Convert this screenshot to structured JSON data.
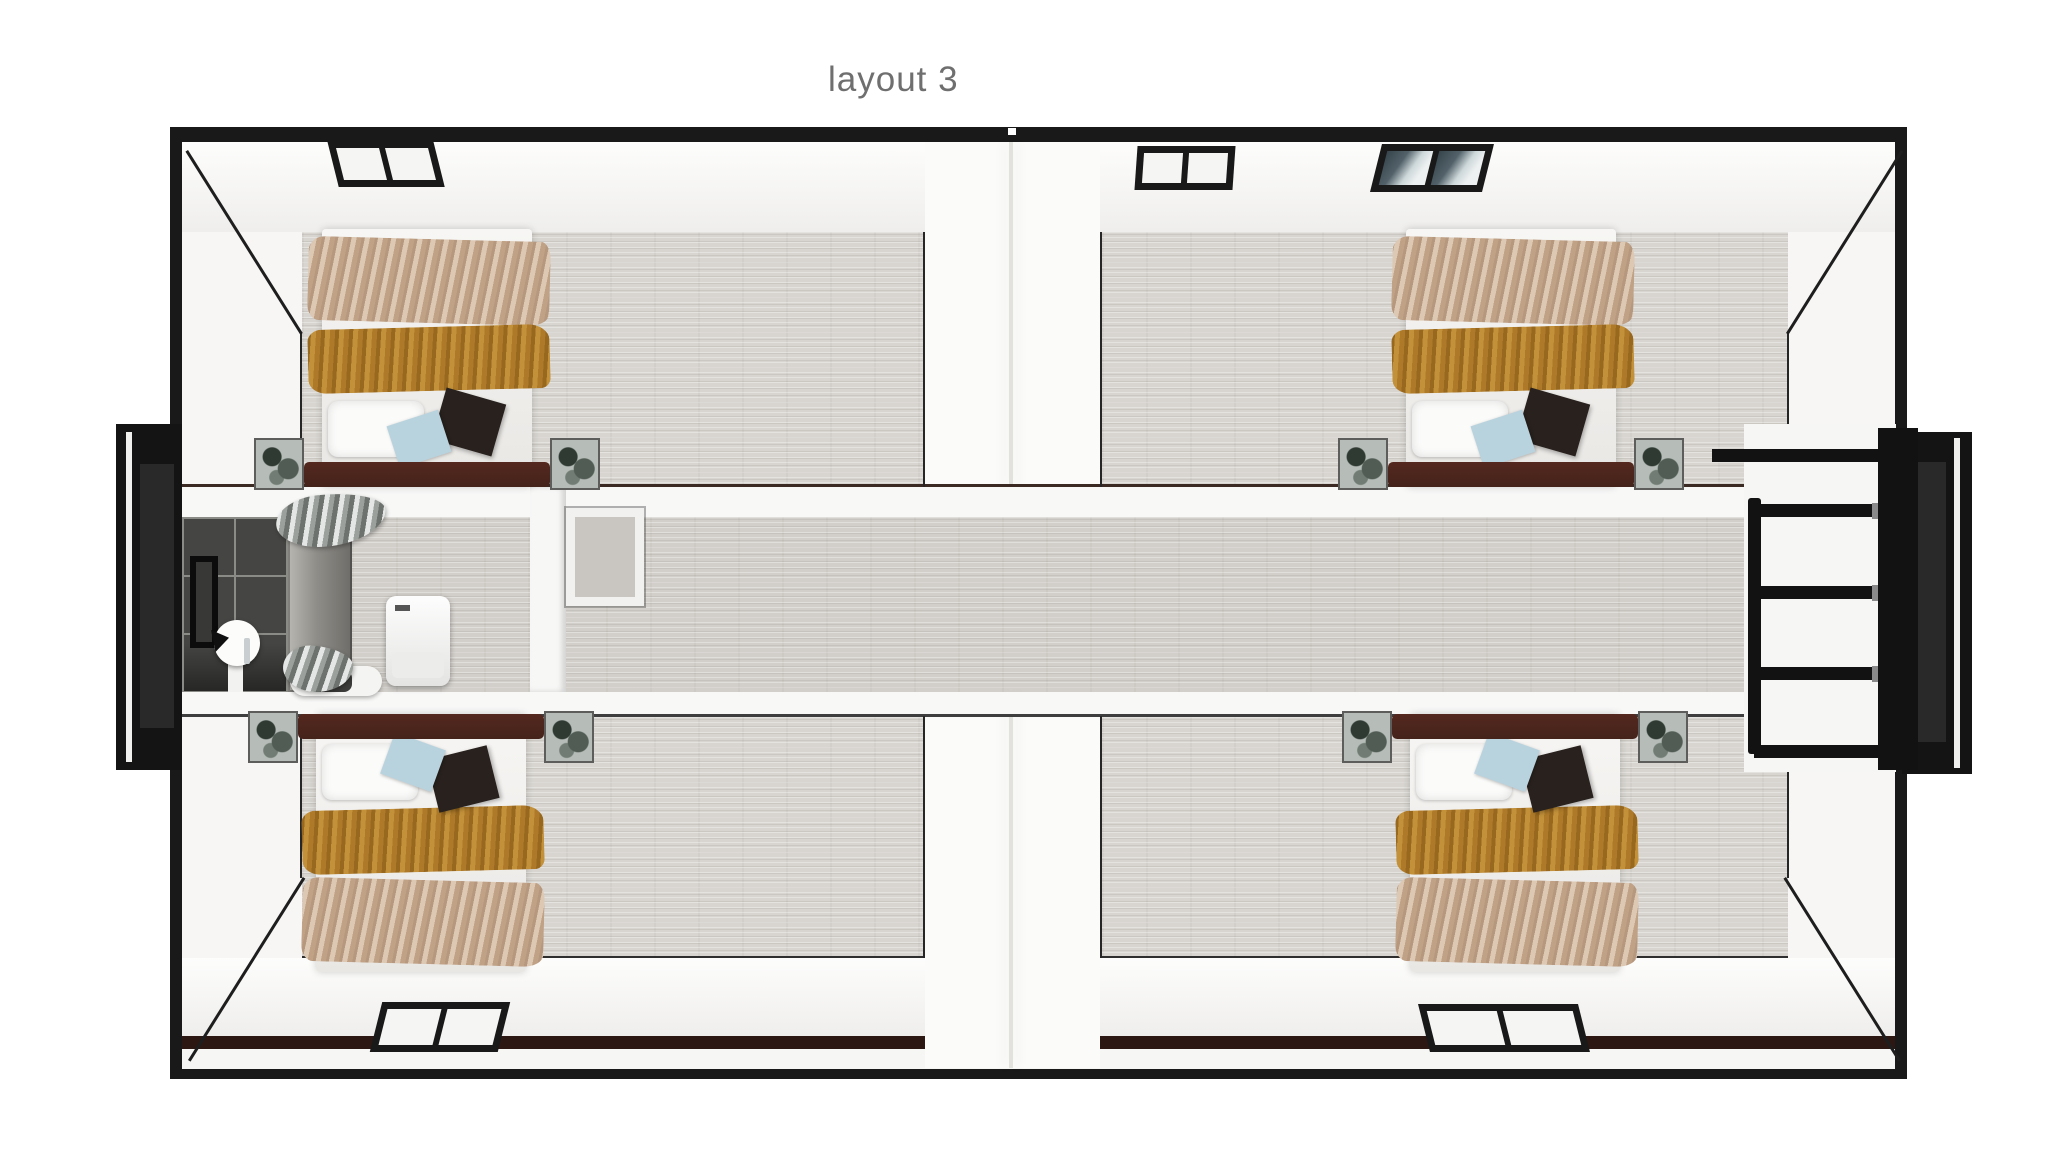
{
  "title": {
    "text": "layout 3"
  },
  "palette": {
    "frame": "#191919",
    "wall_white": "#f4f3f1",
    "floor_wood": "#d8d5d0",
    "floor_corridor": "#d2cfca",
    "tile_dark": "#454543",
    "tile_grout": "#8a8a86",
    "blanket_gold": "#b5832f",
    "blanket_beige": "#c9af97",
    "headboard_brown": "#44231b",
    "window_glass_dark": "#36454b",
    "title_gray": "#6f6f6f"
  },
  "counts": {
    "bedrooms": 4,
    "beds": 4,
    "exterior_windows": 5,
    "bathrooms": 1
  }
}
